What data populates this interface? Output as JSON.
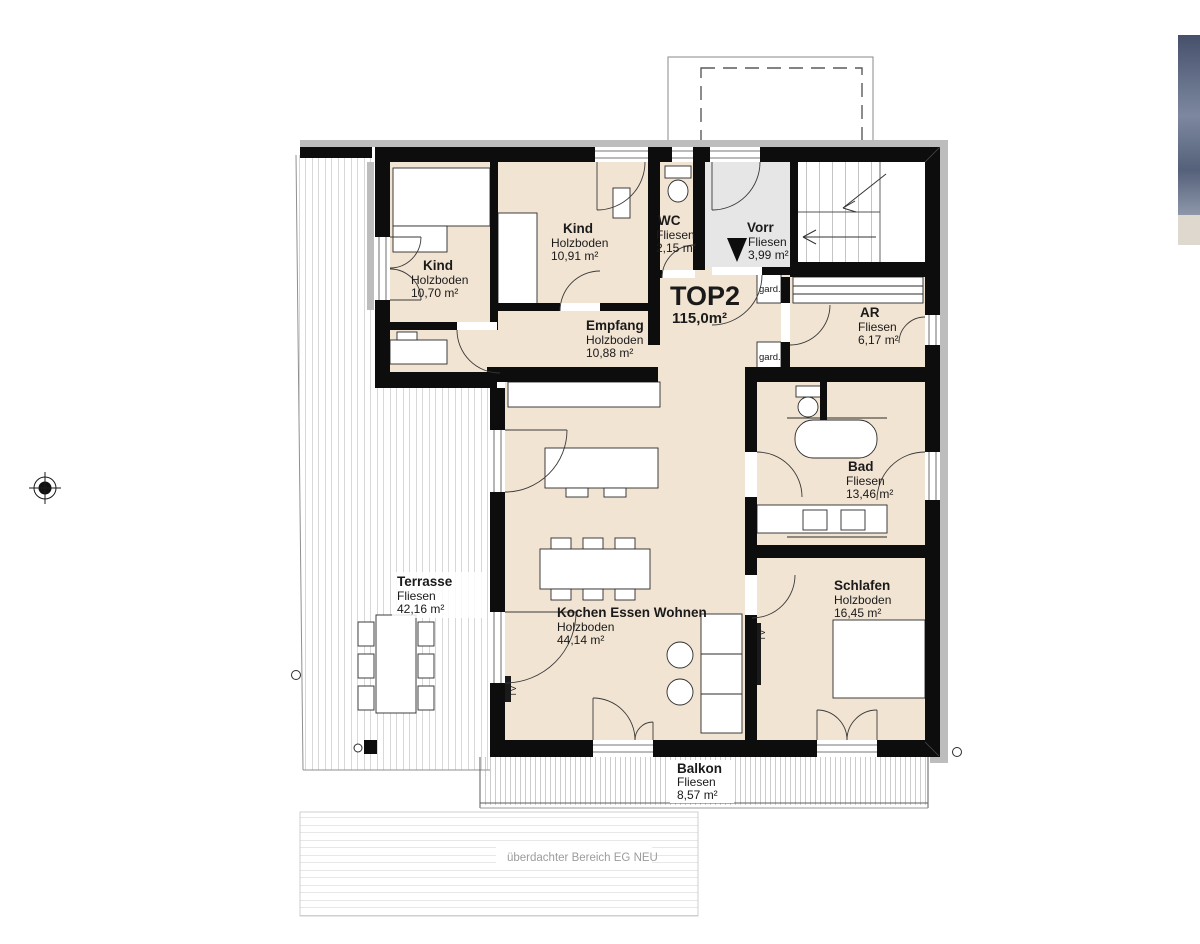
{
  "unit": {
    "name": "TOP2",
    "area": "115,0m²"
  },
  "rooms": {
    "kind_left": {
      "name": "Kind",
      "floor": "Holzboden",
      "area": "10,70 m²"
    },
    "kind_top": {
      "name": "Kind",
      "floor": "Holzboden",
      "area": "10,91 m²"
    },
    "wc": {
      "name": "WC",
      "floor": "Fliesen",
      "area": "2,15 m²"
    },
    "vorraum": {
      "name": "Vorr",
      "floor": "Fliesen",
      "area": "3,99 m²"
    },
    "empfang": {
      "name": "Empfang",
      "floor": "Holzboden",
      "area": "10,88 m²"
    },
    "abstellraum": {
      "name": "AR",
      "floor": "Fliesen",
      "area": "6,17 m²"
    },
    "bad": {
      "name": "Bad",
      "floor": "Fliesen",
      "area": "13,46 m²"
    },
    "schlafen": {
      "name": "Schlafen",
      "floor": "Holzboden",
      "area": "16,45 m²"
    },
    "wohnen": {
      "name": "Kochen Essen Wohnen",
      "floor": "Holzboden",
      "area": "44,14 m²"
    },
    "terrasse": {
      "name": "Terrasse",
      "floor": "Fliesen",
      "area": "42,16 m²"
    },
    "balkon": {
      "name": "Balkon",
      "floor": "Fliesen",
      "area": "8,57 m²"
    }
  },
  "annotations": {
    "covered_area": "überdachter Bereich EG NEU",
    "wardrobe": "gard.",
    "tv": "TV"
  },
  "colors": {
    "room_fill": "#f2e4d3",
    "entry_fill": "#e6e6e6",
    "wall": "#0d0d0d",
    "shadow": "#bdbdbd",
    "hatch": "#9a9a9a",
    "muted_text": "#9c9c9c"
  }
}
